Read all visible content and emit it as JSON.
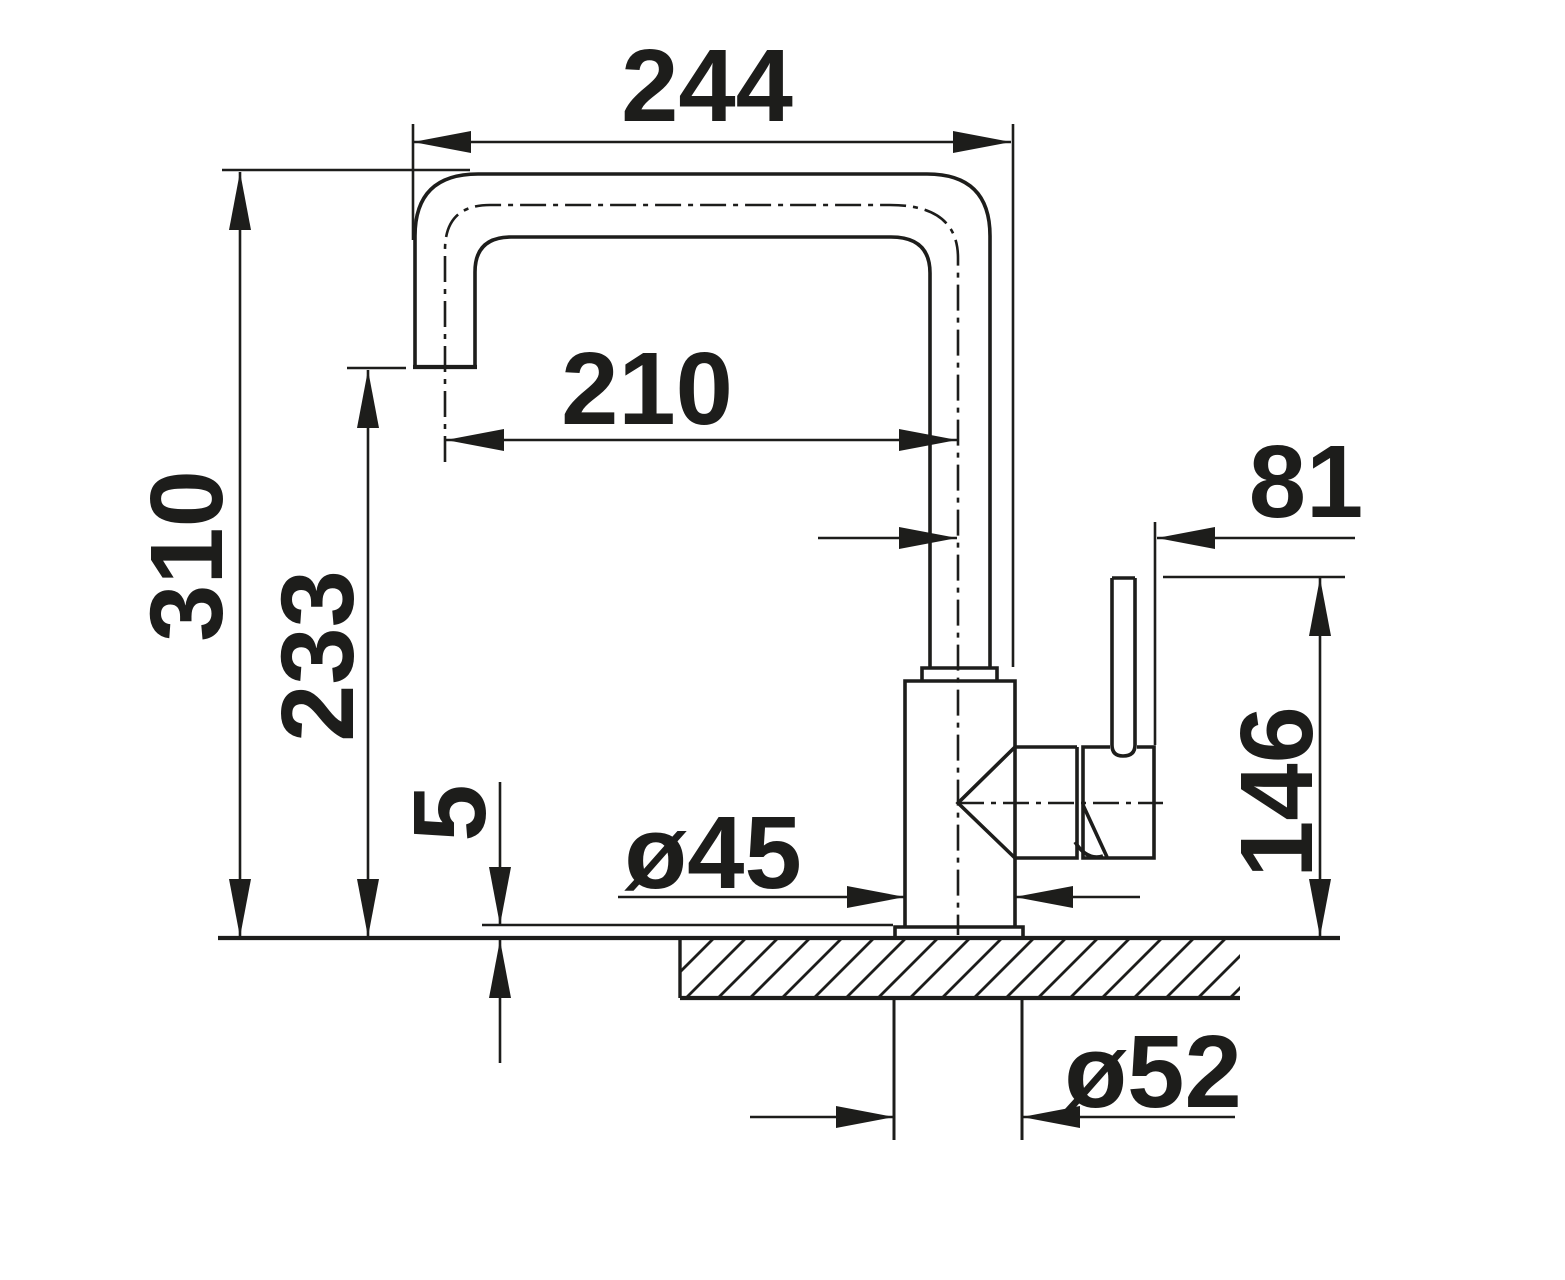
{
  "drawing": {
    "colors": {
      "line": "#1d1d1b",
      "background": "#ffffff"
    },
    "dimensions": {
      "total_reach": {
        "label": "244",
        "value": 244
      },
      "spout_reach": {
        "label": "210",
        "value": 210
      },
      "total_height": {
        "label": "310",
        "value": 310
      },
      "spout_height": {
        "label": "233",
        "value": 233
      },
      "base_plate_height": {
        "label": "5",
        "value": 5
      },
      "lever_offset": {
        "label": "81",
        "value": 81
      },
      "lever_height": {
        "label": "146",
        "value": 146
      },
      "body_diameter": {
        "label": "ø45",
        "value": 45
      },
      "mounting_hole_diameter": {
        "label": "ø52",
        "value": 52
      }
    }
  }
}
